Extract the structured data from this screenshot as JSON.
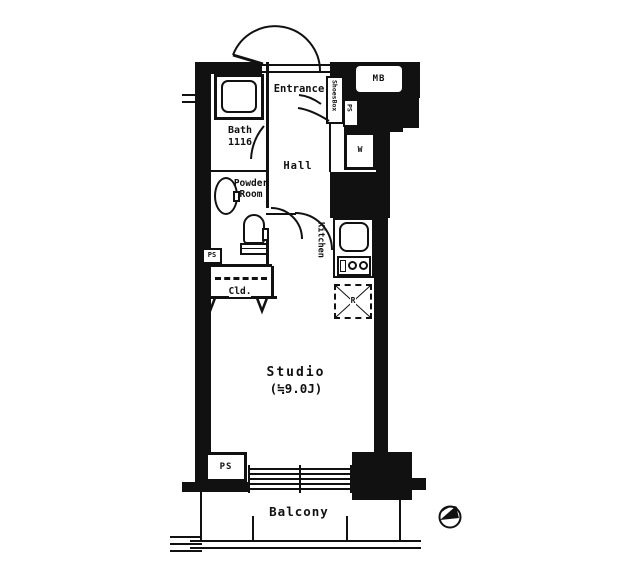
{
  "labels": {
    "entrance": "Entrance",
    "shoes_box": "ShoesBox",
    "meter_box": "MB",
    "ps_top": "PS",
    "washer": "W",
    "bath": "Bath",
    "bath_size": "1116",
    "powder_line1": "Powder",
    "powder_line2": "Room",
    "hall": "Hall",
    "kitchen": "Kitchen",
    "refrigerator": "R",
    "ps_left": "PS",
    "closet": "Cld.",
    "studio": "Studio",
    "studio_size": "(≒9.0J)",
    "ps_bottom": "PS",
    "balcony": "Balcony"
  },
  "colors": {
    "wall": "#111111",
    "line": "#1a1a1a",
    "background": "#ffffff"
  }
}
